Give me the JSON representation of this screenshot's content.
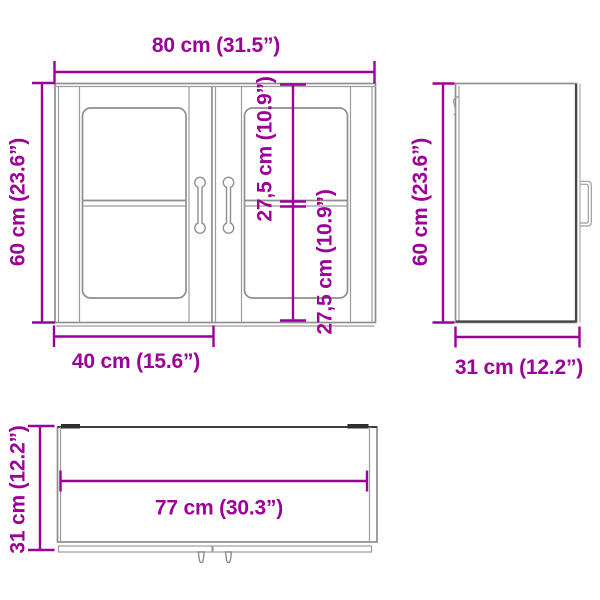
{
  "accent_color": "#9b0098",
  "line_color": "#8f8f8f",
  "dark_line_color": "#3f3f3f",
  "background_color": "#ffffff",
  "views": {
    "front": {
      "title": "front-view-of-wall-cabinet",
      "dims": {
        "width": "80 cm (31.5”)",
        "height": "60 cm (23.6”)",
        "door_width": "40 cm (15.6”)",
        "glass_upper": "27,5 cm (10.9”)",
        "glass_lower": "27,5 cm (10.9”)"
      }
    },
    "side": {
      "title": "side-view-of-wall-cabinet",
      "dims": {
        "height": "60 cm (23.6”)",
        "depth": "31 cm (12.2”)"
      }
    },
    "top": {
      "title": "top-view-of-wall-cabinet",
      "dims": {
        "inner_width": "77 cm (30.3”)",
        "depth": "31 cm (12.2”)"
      }
    }
  }
}
